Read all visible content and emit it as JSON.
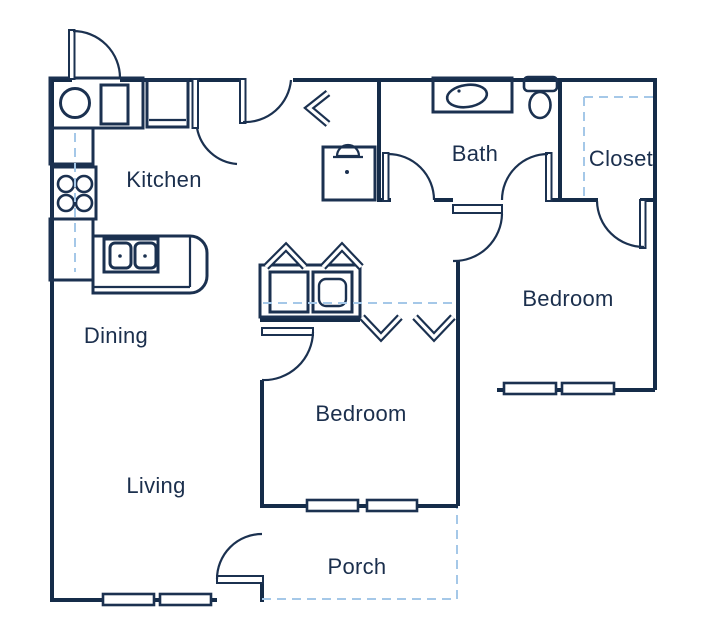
{
  "plan": {
    "title": "Apartment floor plan",
    "rooms": {
      "kitchen": "Kitchen",
      "dining": "Dining",
      "living": "Living",
      "bath": "Bath",
      "closet": "Closet",
      "bedroom_center": "Bedroom",
      "bedroom_right": "Bedroom",
      "porch": "Porch"
    },
    "colors": {
      "wall": "#152c49",
      "fixture": "#1b3150",
      "dashed": "#a5c8e8",
      "text": "#1b2f4d",
      "background": "#ffffff"
    },
    "fixtures": [
      "entry-door",
      "kitchen-sink-counter",
      "refrigerator",
      "range-four-burners",
      "peninsula-counter",
      "double-basin-sink",
      "washer",
      "dryer",
      "water-heater-closet",
      "bifold-closet-doors",
      "bathroom-vanity-sink",
      "toilet",
      "closet-shelf-dashed",
      "windows",
      "porch-outline-dashed"
    ]
  }
}
